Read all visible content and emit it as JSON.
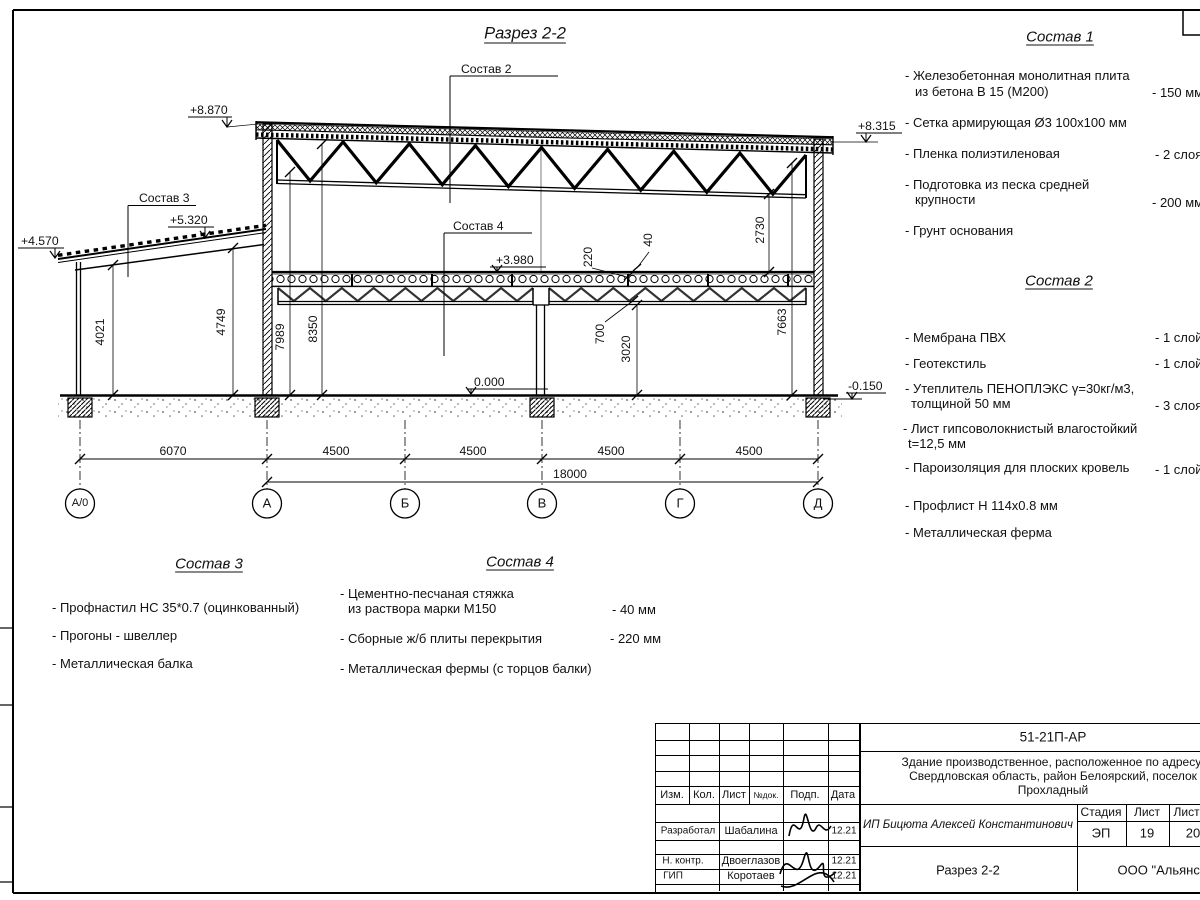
{
  "drawing": {
    "title": "Разрез 2-2",
    "labels": {
      "s2": "Состав 2",
      "s3": "Состав 3",
      "s4": "Состав 4"
    },
    "elevations": {
      "mainLeft": "+8.870",
      "mainRight": "+8.315",
      "annexLeft": "+4.570",
      "annexRight": "+5.320",
      "floor": "+3.980",
      "zero": "0.000",
      "minus": "-0.150"
    },
    "vdims": {
      "a4021": "4021",
      "a4749": "4749",
      "h7989": "7989",
      "h8350": "8350",
      "h2730": "2730",
      "h7663": "7663",
      "t220": "220",
      "t40": "40",
      "t700": "700",
      "t3020": "3020"
    },
    "hdims": {
      "s0": "6070",
      "s1": "4500",
      "s2": "4500",
      "s3": "4500",
      "s4": "4500",
      "total": "18000"
    },
    "axes": {
      "a0": "А/0",
      "a": "А",
      "b": "Б",
      "v": "В",
      "g": "Г",
      "d": "Д"
    }
  },
  "sostav1": {
    "title": "Состав 1",
    "i1a": "- Железобетонная  монолитная плита",
    "i1b": "из бетона В 15 (М200)",
    "i1v": "- 150 мм",
    "i2a": "- Сетка армирующая Ø3 100x100 мм",
    "i3a": "- Пленка полиэтиленовая",
    "i3v": "- 2 слоя",
    "i4a": "- Подготовка из песка средней",
    "i4b": "крупности",
    "i4v": "- 200 мм",
    "i5a": "- Грунт основания"
  },
  "sostav2": {
    "title": "Состав 2",
    "i1a": "- Мембрана ПВХ",
    "i1v": "- 1 слой",
    "i2a": "- Геотекстиль",
    "i2v": "- 1 слой",
    "i3a": "- Утеплитель ПЕНОПЛЭКС γ=30кг/м3,",
    "i3b": "толщиной 50 мм",
    "i3v": "- 3 слоя",
    "i4a": "- Лист гипсоволокнистый влагостойкий",
    "i4b": "t=12,5 мм",
    "i5a": "- Пароизоляция для плоских кровель",
    "i5v": "- 1 слой",
    "i6a": "- Профлист Н 114x0.8 мм",
    "i7a": "- Металлическая ферма"
  },
  "sostav3": {
    "title": "Состав 3",
    "i1a": "- Профнастил НС 35*0.7 (оцинкованный)",
    "i2a": "- Прогоны - швеллер",
    "i3a": "- Металлическая балка"
  },
  "sostav4": {
    "title": "Состав 4",
    "i1a": "- Цементно-песчаная стяжка",
    "i1b": "из раствора марки М150",
    "i1v": "- 40 мм",
    "i2a": "- Сборные ж/б плиты перекрытия",
    "i2v": "- 220 мм",
    "i3a": "- Металлическая фермы (с торцов балки)"
  },
  "titleblock": {
    "doc": "51-21П-АР",
    "obj1": "Здание производственное, расположенное по адресу:",
    "obj2": "Свердловская область, район Белоярский, поселок",
    "obj3": "Прохладный",
    "hIzm": "Изм.",
    "hKol": "Кол.",
    "hList": "Лист",
    "hNdok": "№док.",
    "hPodp": "Подп.",
    "hData": "Дата",
    "r1role": "Разработал",
    "r1name": "Шабалина",
    "r1date": "12.21",
    "r2role": "Н. контр.",
    "r2name": "Двоеглазов",
    "r2date": "12.21",
    "r3role": "ГИП",
    "r3name": "Коротаев",
    "r3date": "12.21",
    "client": "ИП Бицюта Алексей Константинович",
    "stageL": "Стадия",
    "listL": "Лист",
    "listovL": "Листов",
    "stage": "ЭП",
    "list": "19",
    "listov": "20",
    "sheetTitle": "Разрез 2-2",
    "company": "ООО \"Альянс\""
  }
}
